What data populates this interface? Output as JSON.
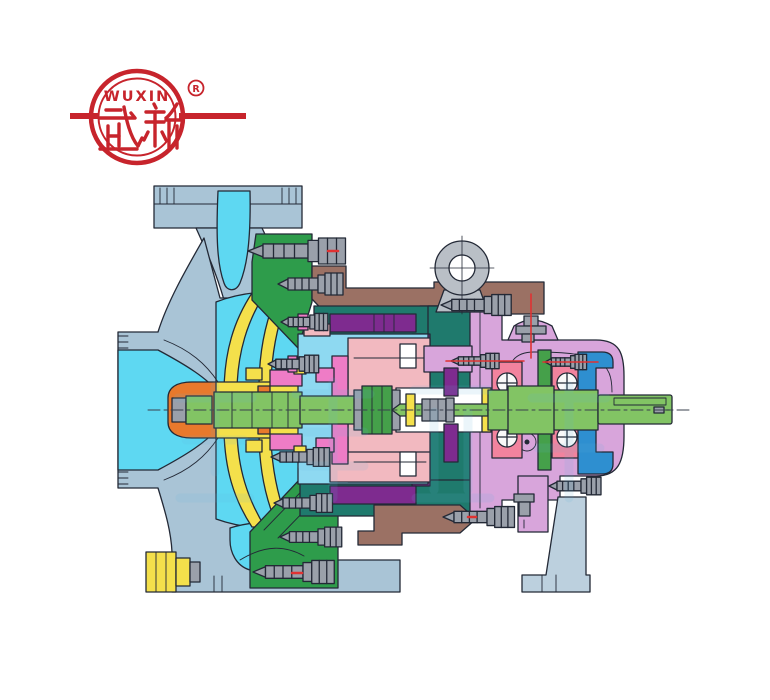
{
  "page": {
    "background": "#FFFFFF",
    "alt": "Cutaway sectional drawing of a WUXIN end-suction centrifugal pump"
  },
  "logo": {
    "brand_latin": "WUXIN",
    "brand_cjk": "武新",
    "registered_mark": "R",
    "color": "#C7242C"
  },
  "watermark": {
    "text": "武新泵业"
  },
  "colors": {
    "casing": "#A9C4D6",
    "foot": "#BCD0DE",
    "flow": "#5ED8F2",
    "chamber": "#8ED9F1",
    "impeller": "#F4E04B",
    "cover": "#2E9C4B",
    "adapter": "#9B7164",
    "frame": "#1F7A6D",
    "purple": "#7E2B8F",
    "rose": "#F2B9C0",
    "magenta": "#EE7CC6",
    "housing": "#D8A5DB",
    "bearing": "#F2839E",
    "endcover": "#2E8FD0",
    "shaft": "#82C464",
    "shaftdark": "#45A04A",
    "orange": "#E8792C",
    "bolt": "#9AA0AA",
    "eye": "#B9BFC6",
    "outline": "#232936",
    "red": "#E03232",
    "logo": "#C7242C",
    "watermark": "#5FB4DC"
  }
}
